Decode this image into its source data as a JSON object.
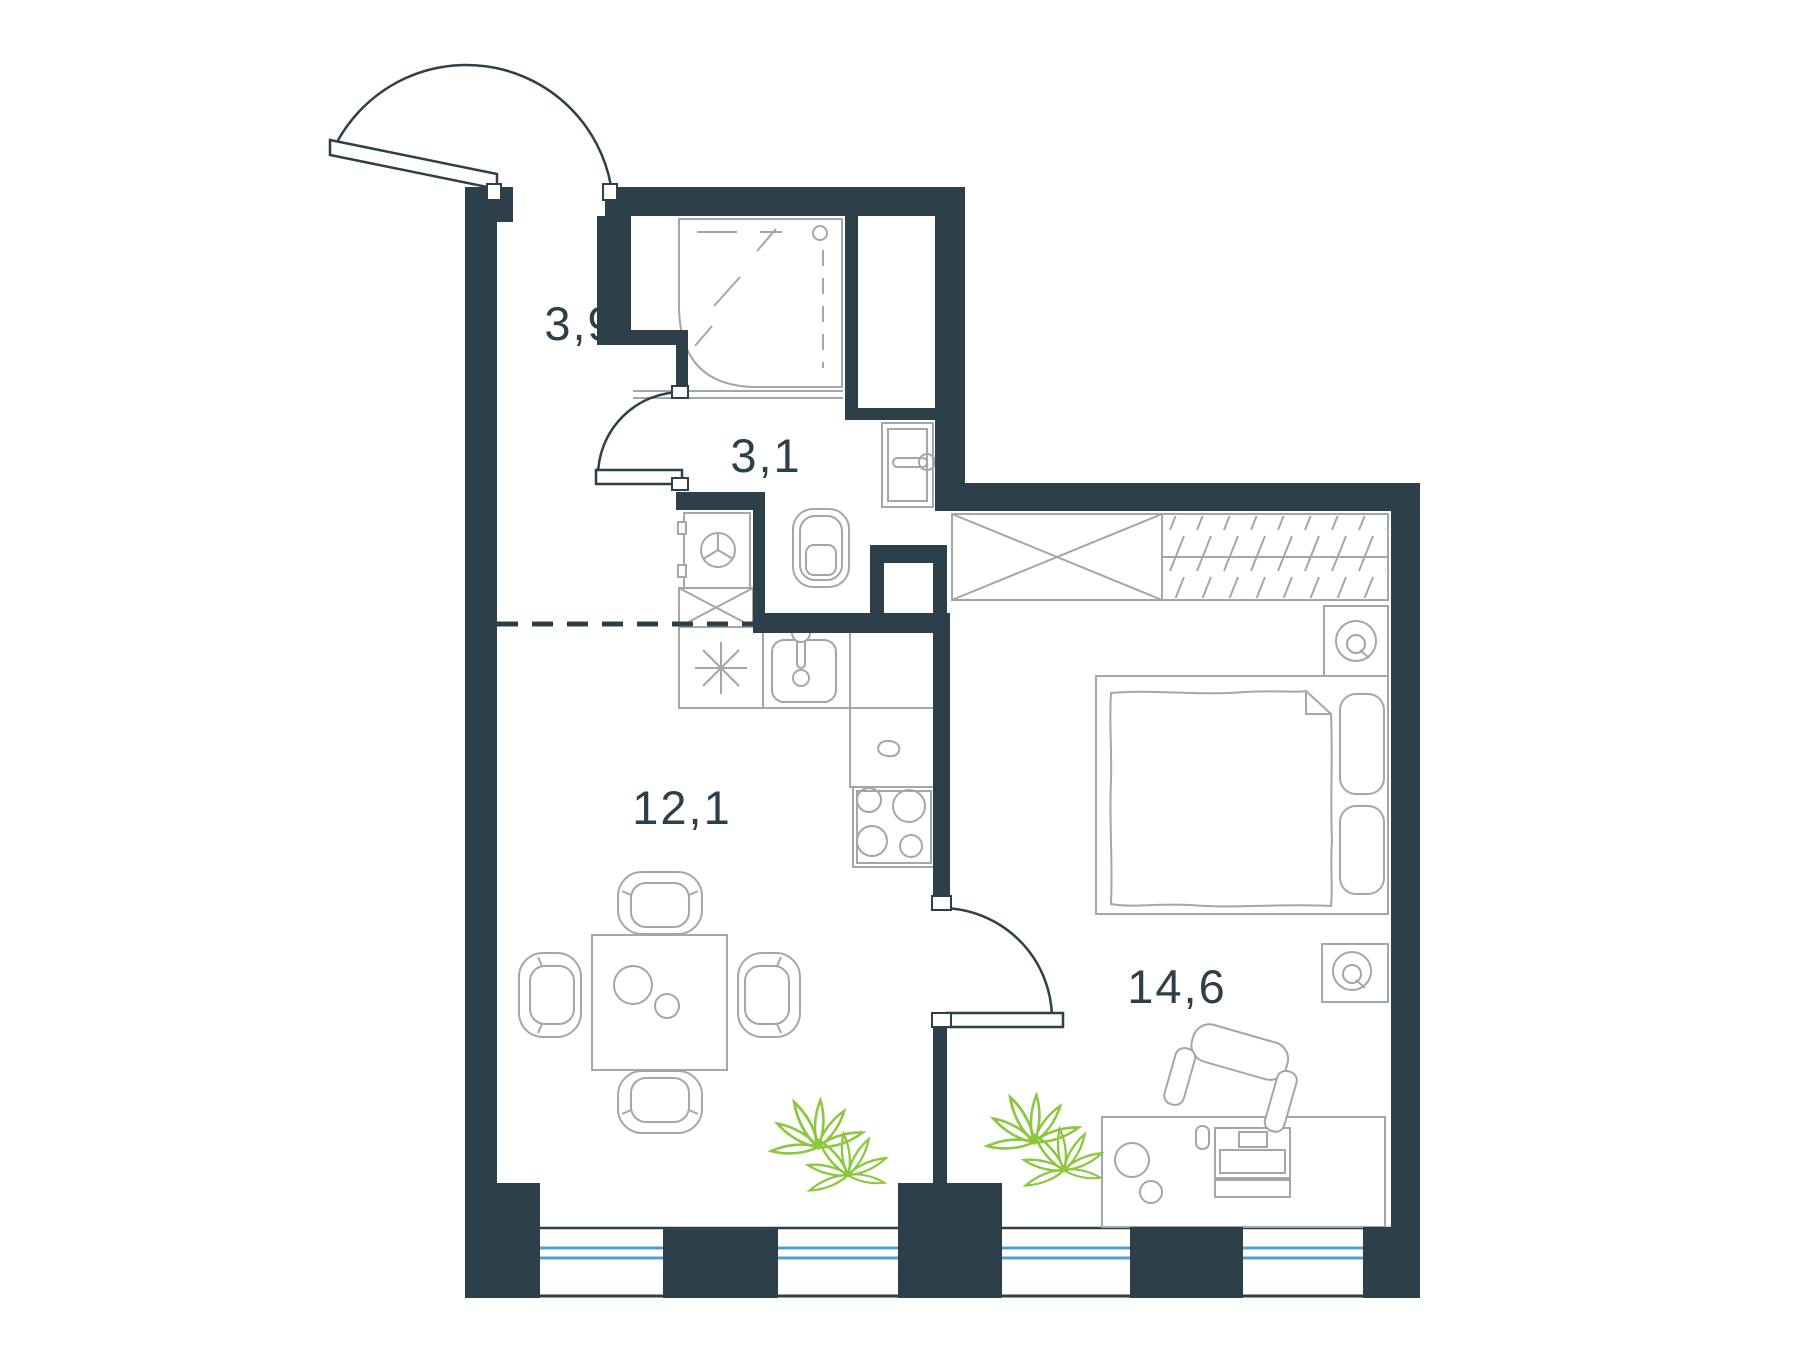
{
  "plan": {
    "type": "apartment-floor-plan",
    "rooms": [
      {
        "id": "hallway",
        "label": "3,9",
        "area_m2": 3.9
      },
      {
        "id": "bathroom",
        "label": "3,1",
        "area_m2": 3.1
      },
      {
        "id": "kitchen-living",
        "label": "12,1",
        "area_m2": 12.1
      },
      {
        "id": "bedroom",
        "label": "14,6",
        "area_m2": 14.6
      }
    ],
    "fixtures": [
      "entrance-door",
      "bathroom-door",
      "bedroom-door",
      "shower-cabin",
      "toilet",
      "washing-machine",
      "crossed-cabinet",
      "star-cabinet",
      "kitchen-sink",
      "stove",
      "wardrobe",
      "double-bed",
      "pillows",
      "nightstand-lamp",
      "desk",
      "laptop",
      "office-chair",
      "dining-table",
      "dining-chairs",
      "plants",
      "windows",
      "kitchen-zone-dashed-line",
      "duct-niche"
    ],
    "colors": {
      "wall": "#2d4049",
      "fixture": "#a3a7a9",
      "plant": "#8dc63f",
      "glass": "#4d9fd8",
      "label": "#2d4049",
      "bg": "#ffffff"
    }
  }
}
